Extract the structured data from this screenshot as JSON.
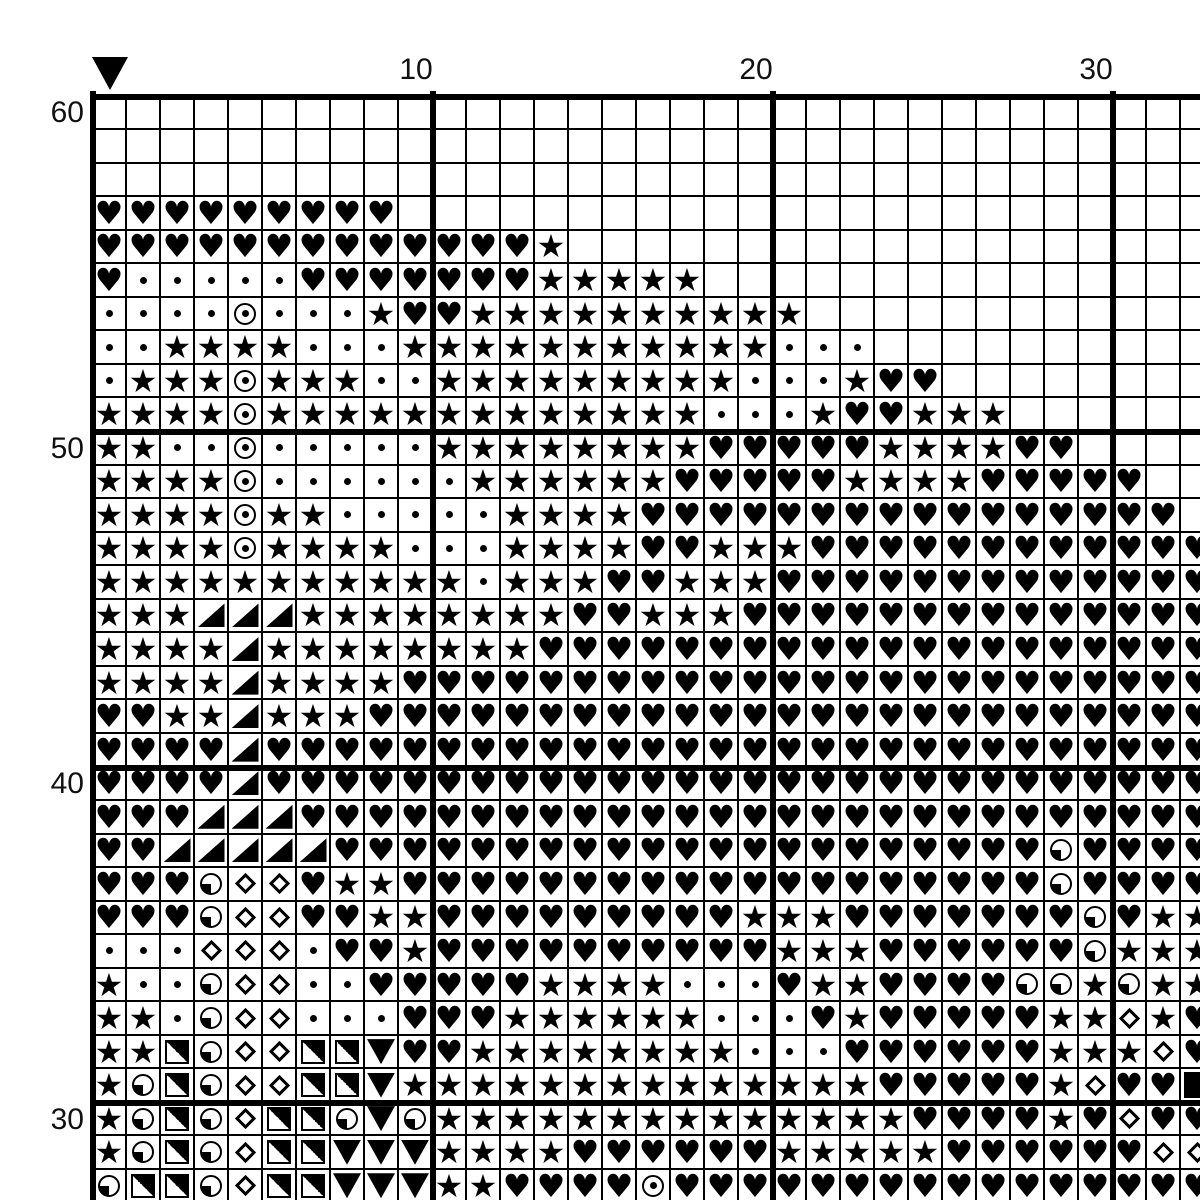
{
  "pattern": {
    "marker": {
      "name": "pattern-start-marker",
      "shape": "filled-down-triangle",
      "at_column": 1
    },
    "top_labels": [
      {
        "text": "10",
        "column": 10
      },
      {
        "text": "20",
        "column": 20
      },
      {
        "text": "30",
        "column": 30
      }
    ],
    "left_labels": [
      {
        "text": "60",
        "row": 60
      },
      {
        "text": "50",
        "row": 50
      },
      {
        "text": "40",
        "row": 40
      },
      {
        "text": "30",
        "row": 30
      }
    ],
    "symbols": {
      "H": {
        "name": "heart",
        "glyph": "♥"
      },
      "S": {
        "name": "star",
        "glyph": "★"
      },
      "d": {
        "name": "dot"
      },
      "O": {
        "name": "circle-dot"
      },
      "T": {
        "name": "corner-triangle"
      },
      "V": {
        "name": "down-triangle"
      },
      "D": {
        "name": "diamond"
      },
      "Q": {
        "name": "quarter-circle"
      },
      "X": {
        "name": "half-square"
      },
      "F": {
        "name": "filled-square"
      },
      ".": {
        "name": "empty"
      }
    },
    "grid": {
      "visible_columns": 33,
      "visible_rows": 33,
      "first_row_number": 60,
      "bold_line_every": 10,
      "rows": [
        {
          "row": 60,
          "cells": "................................."
        },
        {
          "row": 59,
          "cells": "................................."
        },
        {
          "row": 58,
          "cells": "................................."
        },
        {
          "row": 57,
          "cells": "HHHHHHHHH........................"
        },
        {
          "row": 56,
          "cells": "HHHHHHHHHHHHHS..................."
        },
        {
          "row": 55,
          "cells": "HdddddHHHHHHHSSSSS..............."
        },
        {
          "row": 54,
          "cells": "ddddOdddSHHSSSSSSSSSS............"
        },
        {
          "row": 53,
          "cells": "ddSSSSdddSSSSSSSSSSSddd.........."
        },
        {
          "row": 52,
          "cells": "dSSSOSSSddSSSSSSSSSdddSHH........"
        },
        {
          "row": 51,
          "cells": "SSSSOSSSSSSSSSSSSSdddSHHSSS......"
        },
        {
          "row": 50,
          "cells": "SSddOdddddSSSSSSSSHHHHHSSSSHH...."
        },
        {
          "row": 49,
          "cells": "SSSSOddddddSSSSSSHHHHHSSSSHHHHH.."
        },
        {
          "row": 48,
          "cells": "SSSSOSSdddddSSSSHHHHHHHHHHHHHHHH."
        },
        {
          "row": 47,
          "cells": "SSSSOSSSSdddSSSSHHSSSHHHHHHHHHHHH"
        },
        {
          "row": 46,
          "cells": "SSSSSSSSSSSdSSSHHSSSHHHHHHHHHHHHH"
        },
        {
          "row": 45,
          "cells": "SSSTTTSSSSSSSSHHSSSHHHHHHHHHHHHHH"
        },
        {
          "row": 44,
          "cells": "SSSSTSSSSSSSSHHHHHHHHHHHHHHHHHHHH"
        },
        {
          "row": 43,
          "cells": "SSSSTSSSSHHHHHHHHHHHHHHHHHHHHHHHH"
        },
        {
          "row": 42,
          "cells": "HHSSTSSSHHHHHHHHHHHHHHHHHHHHHHHHH"
        },
        {
          "row": 41,
          "cells": "HHHHTHHHHHHHHHHHHHHHHHHHHHHHHHHHH"
        },
        {
          "row": 40,
          "cells": "HHHHTHHHHHHHHHHHHHHHHHHHHHHHHHHHH"
        },
        {
          "row": 39,
          "cells": "HHHTTTHHHHHHHHHHHHHHHHHHHHHHHHHHH"
        },
        {
          "row": 38,
          "cells": "HHTTTTTHHHHHHHHHHHHHHHHHHHHHQHHHH"
        },
        {
          "row": 37,
          "cells": "HHHQDDHSSHHHHHHHHHHHHHHHHHHHQHHHH"
        },
        {
          "row": 36,
          "cells": "HHHQDDHHSSHHHHHHHHHSSSHHHHHHHQHSS"
        },
        {
          "row": 35,
          "cells": "dddDDDdHHSHHHHHHHHHHSSSHHHHHHQSSS"
        },
        {
          "row": 34,
          "cells": "SddQDDddHHHHHSSSSdddHSSHHHHQQSQSS"
        },
        {
          "row": 33,
          "cells": "SSdQDDdddHHHSSSSSSdddHSHHHHHSSDSH"
        },
        {
          "row": 32,
          "cells": "SSXQDDXXVHHSSSSSSSSdddHHHHHHSSSDH"
        },
        {
          "row": 31,
          "cells": "SQXQDDXXVSSSSSSSSSSSSSSHHHHHSDHHF"
        },
        {
          "row": 30,
          "cells": "SQXQDXXQVQSSSSSSSSSSSSSSHHHHSHDHH"
        },
        {
          "row": 29,
          "cells": "SQXQDXXVVVSSSSHHHHHHSSSSSHHHHHHDD"
        },
        {
          "row": 28,
          "cells": "QXXQDXXVVVSSHHHHOHHHHHHHHHHHHHHHH"
        }
      ]
    },
    "colors": {
      "ink": "#000000",
      "background": "#ffffff"
    }
  }
}
